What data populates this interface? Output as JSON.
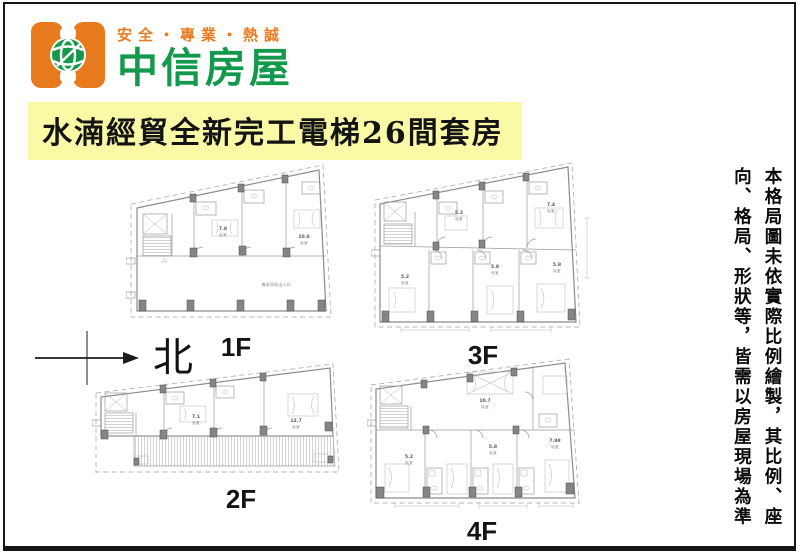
{
  "brand": {
    "tagline": "安全・專業・熱誠",
    "name": "中信房屋",
    "colors": {
      "orange": "#e87a1e",
      "green": "#14994c"
    }
  },
  "title": {
    "text": "水湳經貿全新完工電梯26間套房",
    "bg_color": "#fafaa6"
  },
  "compass": {
    "label": "北"
  },
  "plans": [
    {
      "label": "1F",
      "rooms": [
        {
          "area": "7.8",
          "type": "臥室"
        },
        {
          "area": "10.0",
          "type": "臥室"
        }
      ],
      "note": "機車停車出入口"
    },
    {
      "label": "2F",
      "rooms": [
        {
          "area": "7.1",
          "type": "臥室"
        },
        {
          "area": "12.7",
          "type": "臥室"
        }
      ]
    },
    {
      "label": "3F",
      "rooms": [
        {
          "area": "5.2",
          "type": "臥室"
        },
        {
          "area": "7.4",
          "type": "臥室"
        },
        {
          "area": "5.8",
          "type": "臥室"
        },
        {
          "area": "5.8",
          "type": "臥室"
        },
        {
          "area": "5.2",
          "type": "臥室"
        }
      ]
    },
    {
      "label": "4F",
      "rooms": [
        {
          "area": "10.7",
          "type": "臥室"
        },
        {
          "area": "5.8",
          "type": "臥室"
        },
        {
          "area": "7.98",
          "type": "臥室"
        },
        {
          "area": "5.2",
          "type": "臥室"
        }
      ]
    }
  ],
  "disclaimer": {
    "line1": "本格局圖未依實際比例繪製，其比例、座",
    "line2": "向、格局、形狀等，皆需以房屋現場為準"
  }
}
